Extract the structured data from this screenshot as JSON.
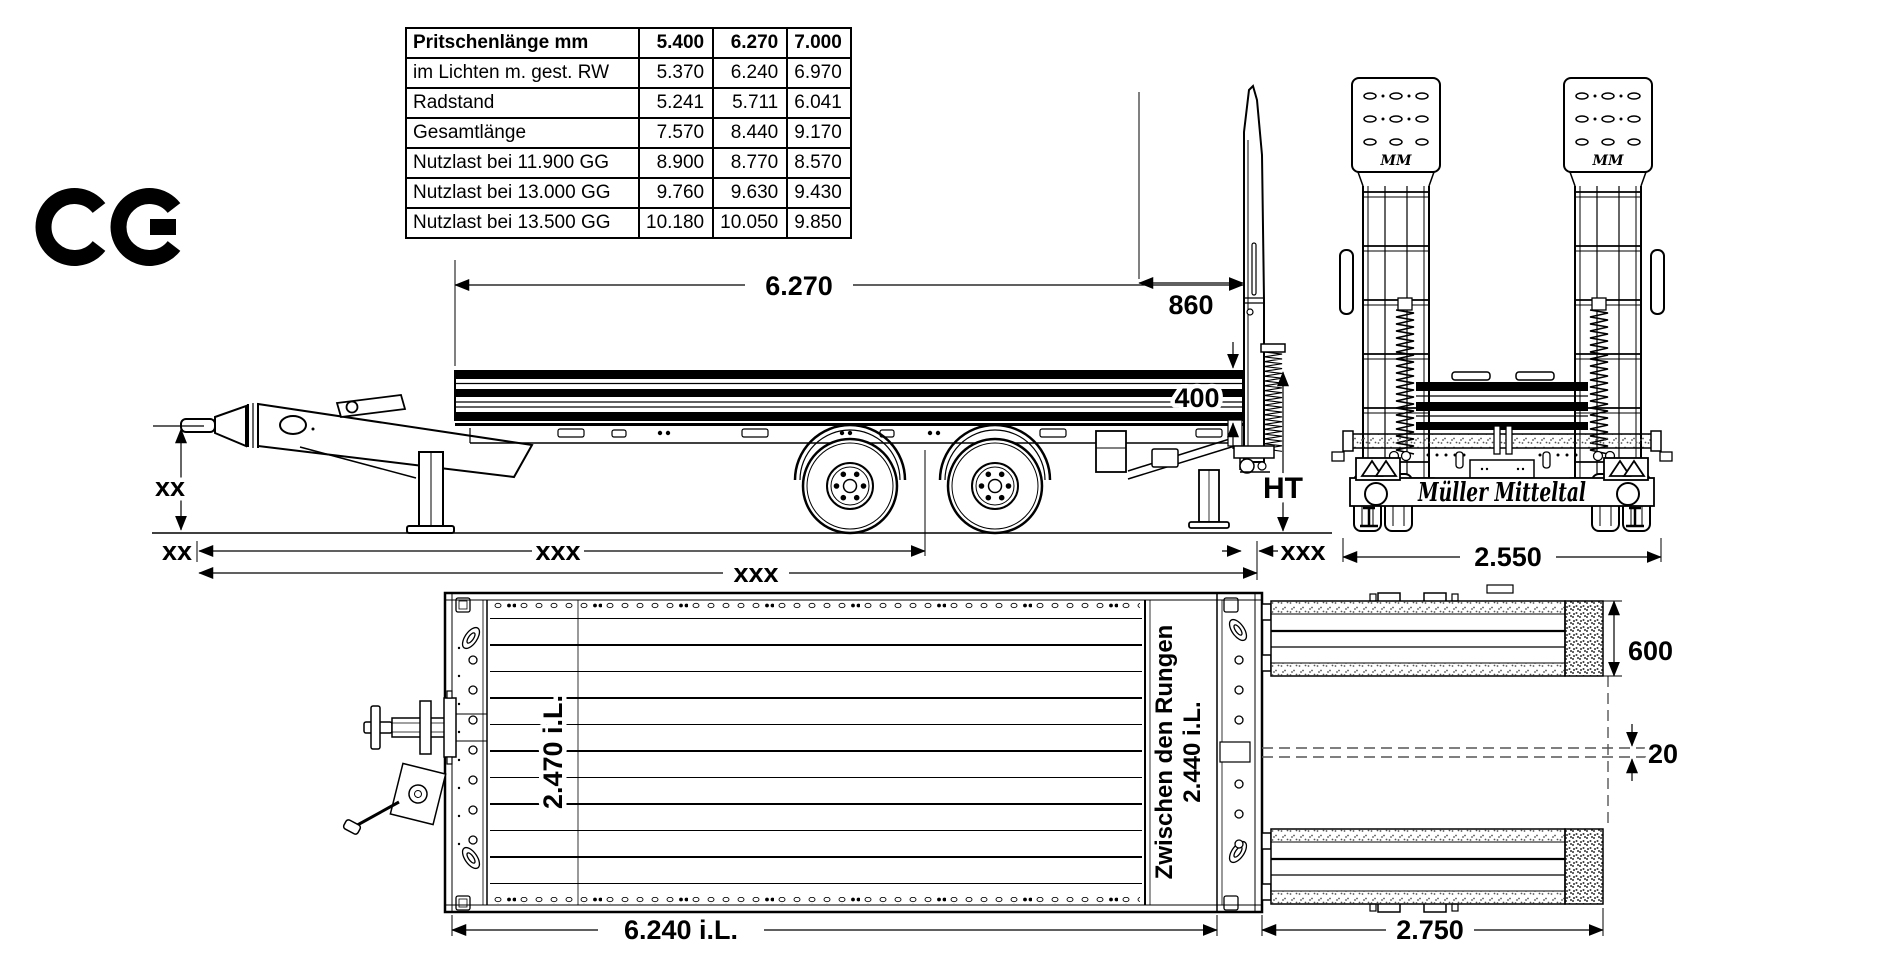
{
  "colors": {
    "line": "#000000",
    "background": "#ffffff",
    "dash": "#555555"
  },
  "ce_mark": {
    "label": "CE"
  },
  "spec_table": {
    "rows": [
      {
        "label": "Pritschenlänge mm",
        "values": [
          "5.400",
          "6.270",
          "7.000"
        ]
      },
      {
        "label": "im Lichten m. gest. RW",
        "values": [
          "5.370",
          "6.240",
          "6.970"
        ]
      },
      {
        "label": "Radstand",
        "values": [
          "5.241",
          "5.711",
          "6.041"
        ]
      },
      {
        "label": "Gesamtlänge",
        "values": [
          "7.570",
          "8.440",
          "9.170"
        ]
      },
      {
        "label": "Nutzlast bei 11.900 GG",
        "values": [
          "8.900",
          "8.770",
          "8.570"
        ]
      },
      {
        "label": "Nutzlast bei 13.000 GG",
        "values": [
          "9.760",
          "9.630",
          "9.430"
        ]
      },
      {
        "label": "Nutzlast bei 13.500 GG",
        "values": [
          "10.180",
          "10.050",
          "9.850"
        ]
      }
    ]
  },
  "side_view": {
    "dim_bed_length": "6.270",
    "dim_rear_section": "860",
    "dim_board_height": "400",
    "dim_loading_height": "HT",
    "dim_coupling_height": "xx",
    "dim_front_overhang": "xx",
    "dim_eye_to_axles": "xxx",
    "dim_overall_length": "xxx",
    "dim_rear_detail": "xxx"
  },
  "rear_view": {
    "dim_overall_width": "2.550",
    "brand_logo": "Müller Mitteltal",
    "ramp_plate_logo": "MM"
  },
  "top_view": {
    "dim_inner_width": "2.470 i.L.",
    "between_stanchions_label": "Zwischen den Rungen",
    "dim_between_stanchions": "2.440 i.L.",
    "dim_inner_length": "6.240 i.L.",
    "dim_ramp_length": "2.750",
    "dim_ramp_width": "600",
    "dim_centerline_offset": "20"
  }
}
